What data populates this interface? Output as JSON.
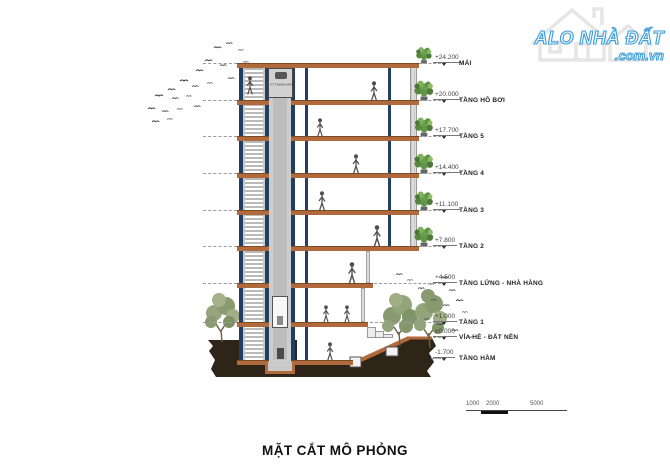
{
  "watermark": {
    "brand": "ALO NHÀ ĐẤT",
    "domain": ".com.vn"
  },
  "drawing": {
    "title": "MẶT CẮT MÔ PHỎNG",
    "elevator_room_label": "KT THANG MÁY",
    "levels": [
      {
        "elevation": "+24.200",
        "label": "MÁI"
      },
      {
        "elevation": "+20.000",
        "label": "TẦNG HỒ BƠI"
      },
      {
        "elevation": "+17.700",
        "label": "TẦNG 5"
      },
      {
        "elevation": "+14.400",
        "label": "TẦNG 4"
      },
      {
        "elevation": "+11.100",
        "label": "TẦNG 3"
      },
      {
        "elevation": "+7.800",
        "label": "TẦNG 2"
      },
      {
        "elevation": "+4.500",
        "label": "TẦNG LỬNG - NHÀ HÀNG"
      },
      {
        "elevation": "+1.000",
        "label": "TẦNG 1"
      },
      {
        "elevation": "±0.000",
        "label": "VỈA HÈ - ĐẤT NỀN"
      },
      {
        "elevation": "-1.700",
        "label": "TẦNG HẦM"
      }
    ],
    "scale_bar": {
      "labels": [
        "1000",
        "2000",
        "5000"
      ]
    },
    "colors": {
      "slab_orange": "#b06a3b",
      "structure_blue": "#1f3f63",
      "earth_brown": "#2e2418",
      "shaft_gray": "#c9c9c9",
      "foliage_green": "#8a9a70",
      "plant_green": "#5e9145",
      "watermark_blue": "#3f9fd8"
    }
  }
}
